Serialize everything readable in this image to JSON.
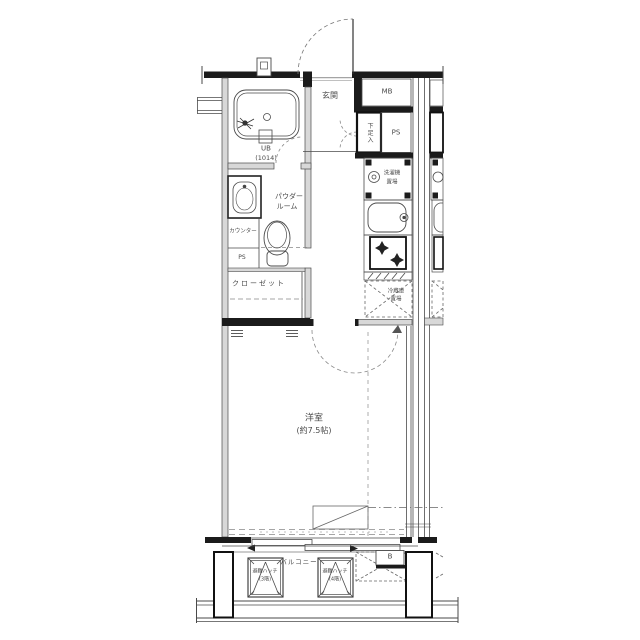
{
  "plan": {
    "type": "apartment-floor-plan",
    "labels": {
      "genkan": "玄関",
      "mb": "MB",
      "ps_top": "PS",
      "shoe_box": "下足入",
      "ub": "UB",
      "ub_size": "(1014)",
      "powder_1": "パウダー",
      "powder_2": "ルーム",
      "counter": "カウンター",
      "ps_left": "PS",
      "closet": "クローゼット",
      "washer_1": "洗濯機",
      "washer_2": "置場",
      "fridge_1": "冷蔵庫",
      "fridge_2": "置場",
      "room_1": "洋室",
      "room_2": "(約7.5帖)",
      "balcony": "バルコニー",
      "hatch3_1": "避難ハッチ",
      "hatch3_2": "(3階)",
      "hatch4_1": "避難ハッチ",
      "hatch4_2": "(4階)",
      "b_mark": "B"
    },
    "colors": {
      "line": "#4a4a4a",
      "wall": "#1b1b1b",
      "partition_fill": "#d8d8d8",
      "background": "#ffffff"
    }
  }
}
